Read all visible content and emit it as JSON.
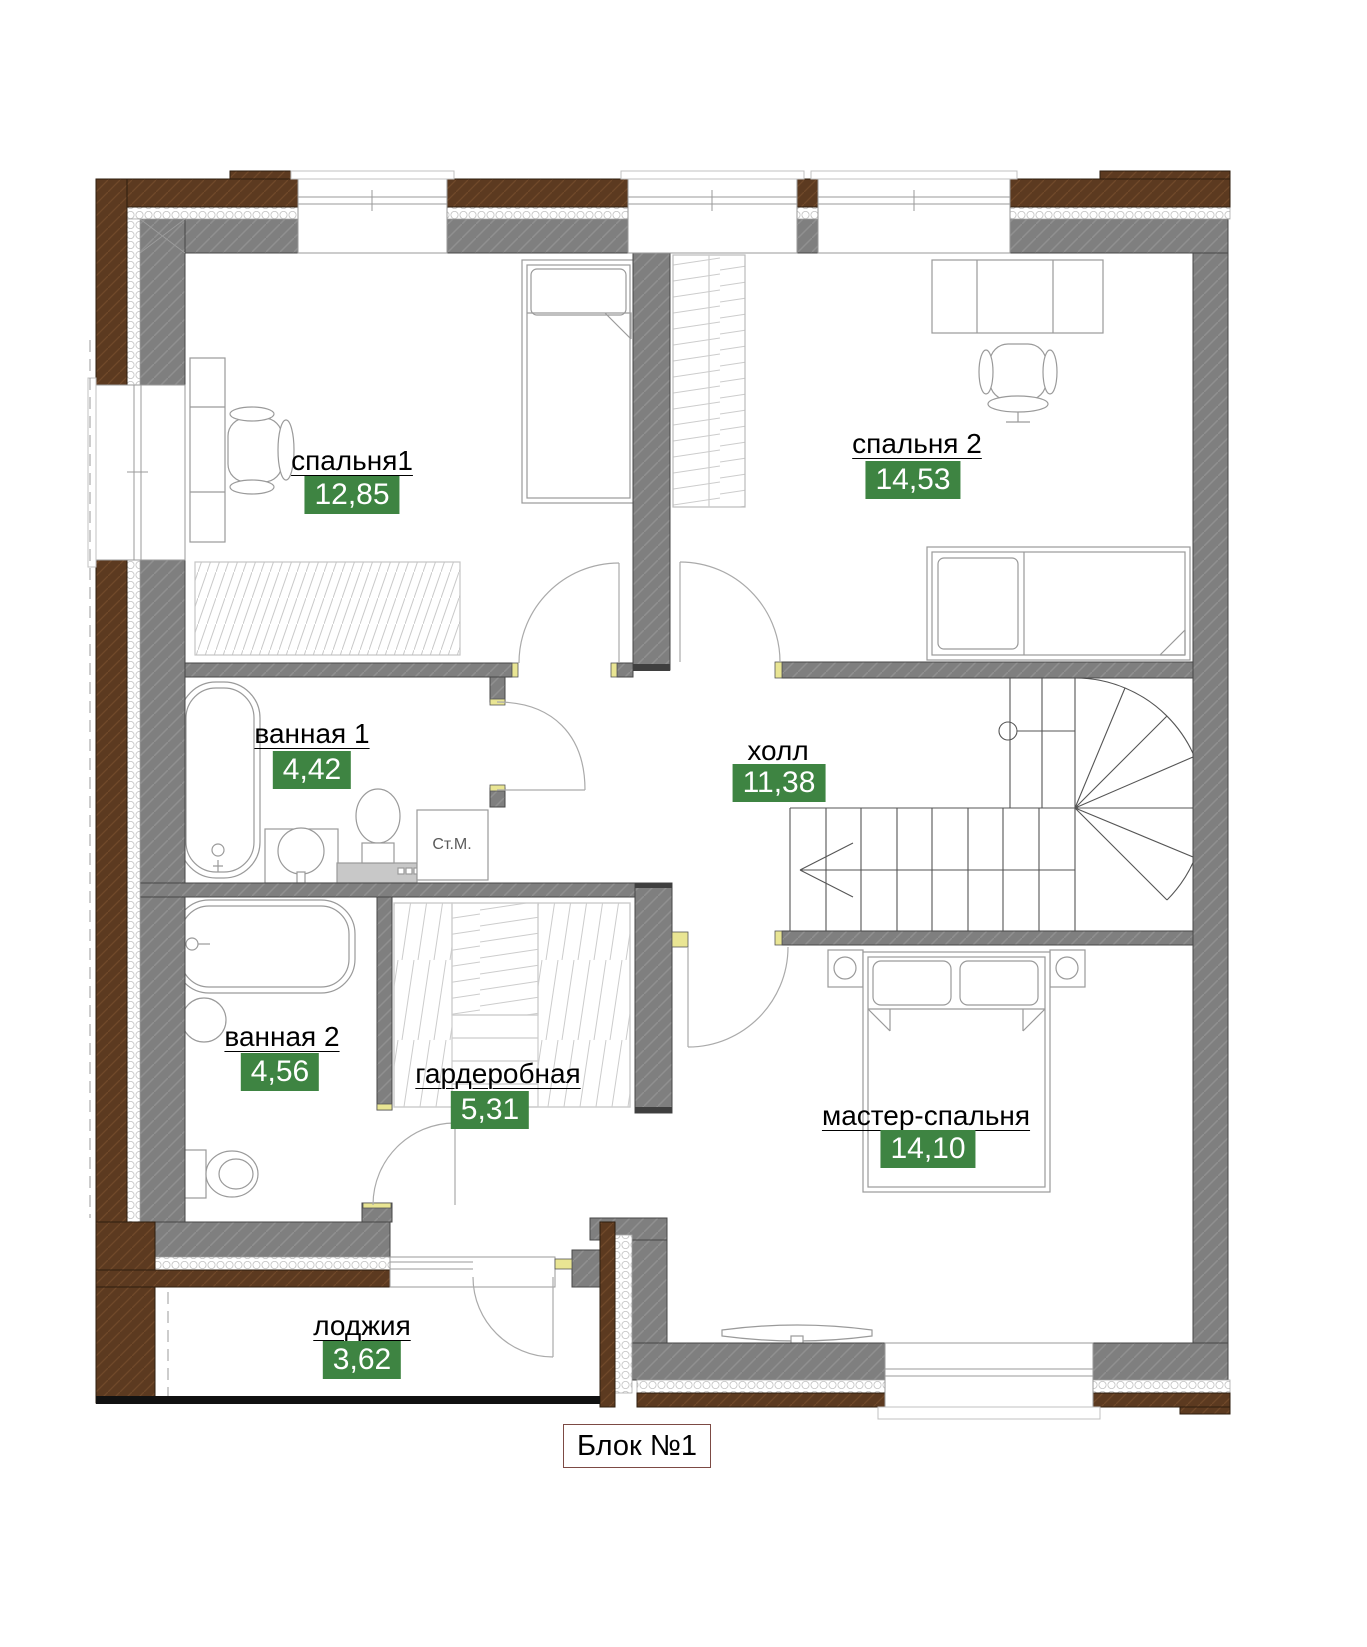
{
  "floor_plan": {
    "block_label": "Блок №1",
    "washing_machine_label": "Ст.М.",
    "rooms": [
      {
        "name": "спальня1",
        "area": "12,85"
      },
      {
        "name": "спальня 2",
        "area": "14,53"
      },
      {
        "name": "ванная 1",
        "area": "4,42"
      },
      {
        "name": "холл",
        "area": "11,38"
      },
      {
        "name": "ванная 2",
        "area": "4,56"
      },
      {
        "name": "гардеробная",
        "area": "5,31"
      },
      {
        "name": "мастер-спальня",
        "area": "14,10"
      },
      {
        "name": "лоджия",
        "area": "3,62"
      }
    ],
    "colors": {
      "badge_green": "#3e8442",
      "wall_gray": "#7f7f7f",
      "timber_brown": "#5c3a20",
      "jamb_yellow": "#e9e593",
      "loggia_front_black": "#111111"
    }
  }
}
